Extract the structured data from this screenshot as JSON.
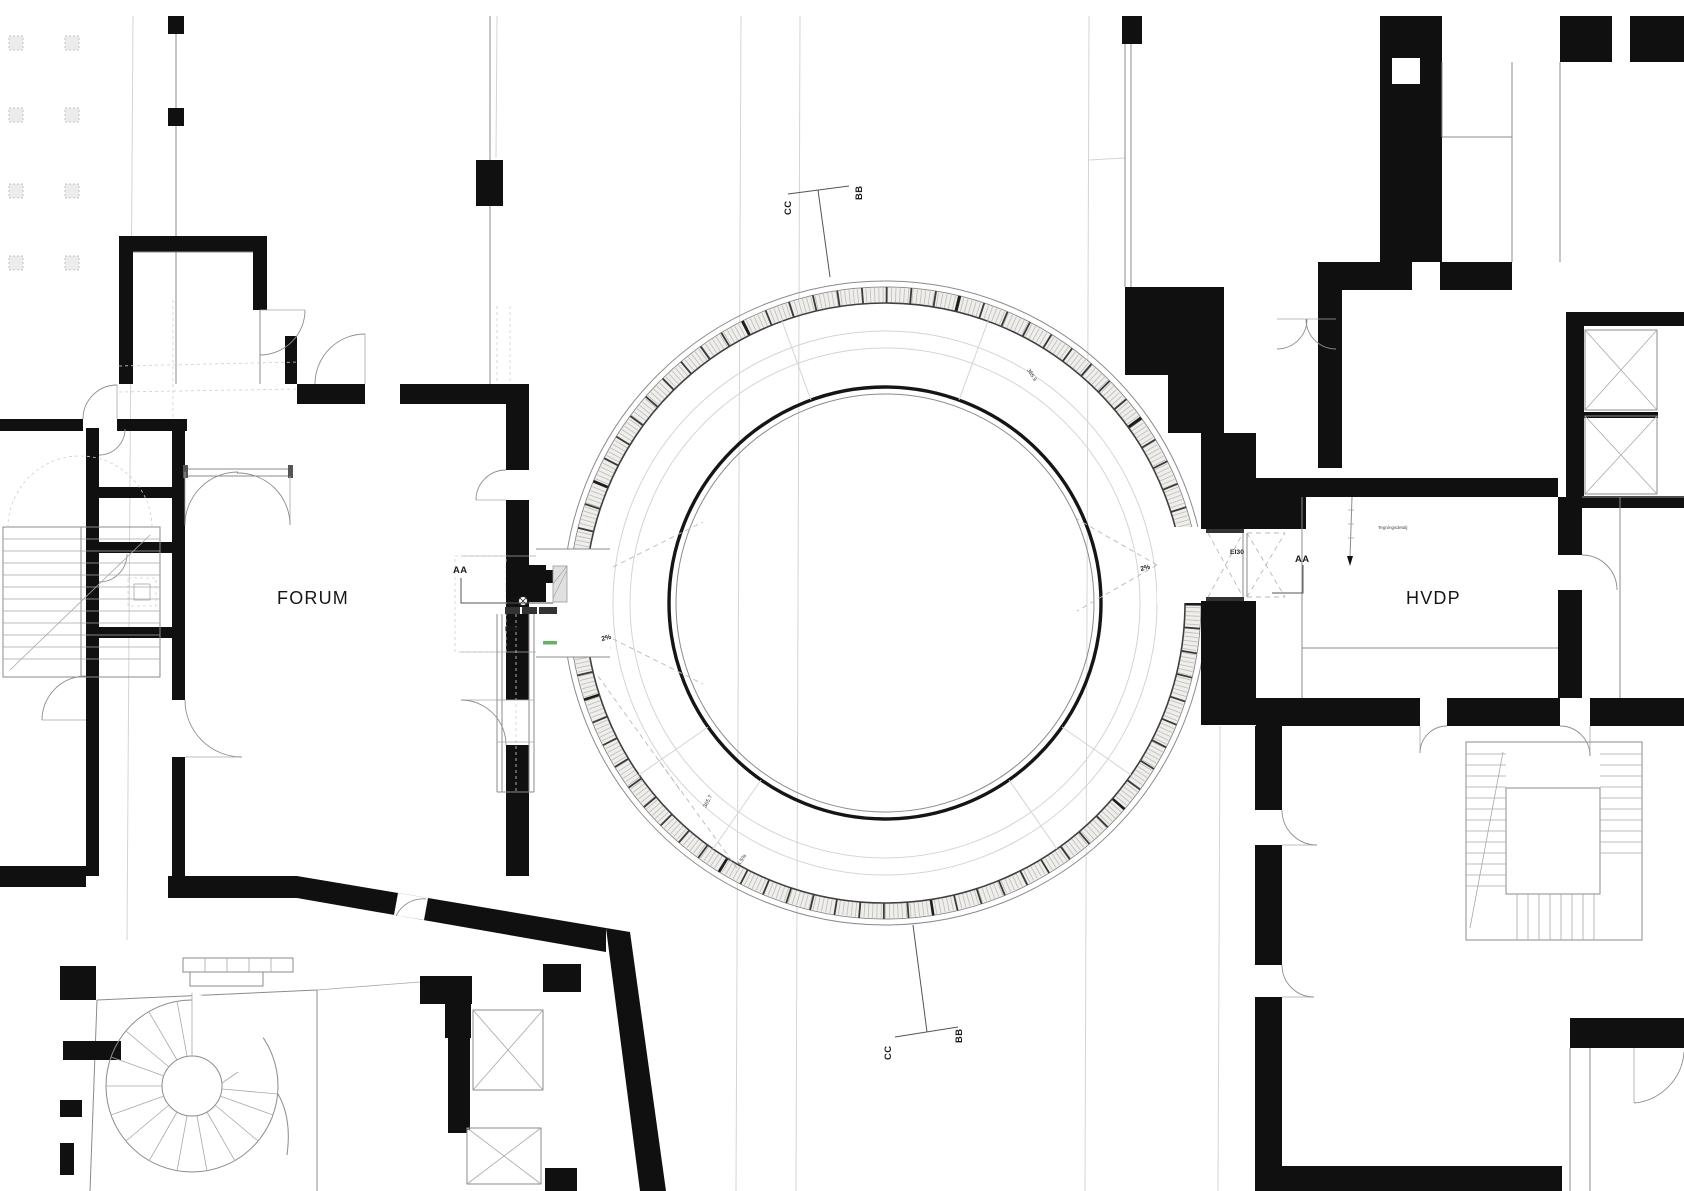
{
  "drawing": {
    "title": "Floor plan — circular link bridge between Forum and HVDP",
    "type": "architectural-plan"
  },
  "labels": {
    "forum": "FORUM",
    "hvdp": "HVDP"
  },
  "section_markers": {
    "aa_left": "AA",
    "aa_right": "AA",
    "cc_top": "CC",
    "bb_top": "BB",
    "cc_bottom": "CC",
    "bb_bottom": "BB"
  },
  "annotations": {
    "slope_left": "2%",
    "slope_right": "2%",
    "fire_rating_left": "EI30",
    "fire_rating_right": "EI30",
    "ring_note_1": "365.7",
    "ring_note_2": "4.5%",
    "ring_note_3": "365.9",
    "detail_note": "Tegningsdetalj"
  },
  "colors": {
    "wall_poche": "#101010",
    "line_gray": "#8b8b8b",
    "faint_gray": "#d4d4d4",
    "green_note": "#4aa54a",
    "background": "#ffffff"
  }
}
